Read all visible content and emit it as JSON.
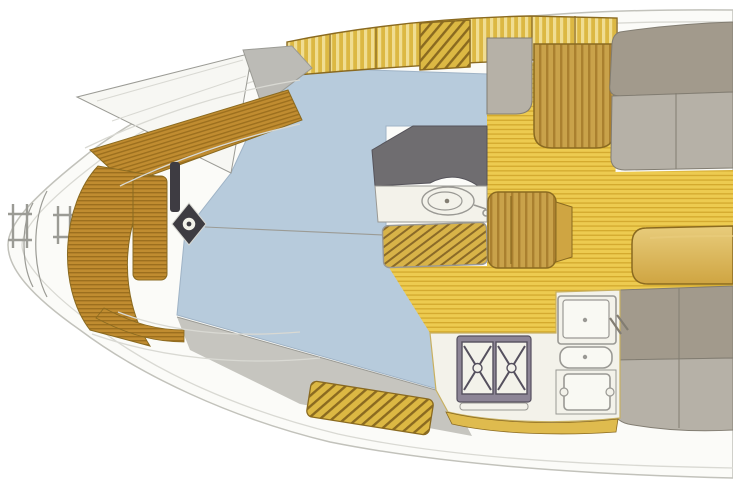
{
  "canvas": {
    "width": 733,
    "height": 488,
    "background": "#ffffff"
  },
  "plan": {
    "type": "sailboat-interior-floor-plan",
    "orientation": "stern-left-bow-right-cropped",
    "regions": [
      "stern-swim-ladder",
      "cockpit",
      "cockpit-teak-benches",
      "helm-pedestal",
      "steering-wheel",
      "sprayhood",
      "companionway-hatch",
      "coachroof",
      "side-deck",
      "deck-lockers",
      "companionway-steps",
      "nav-seat",
      "chart-table",
      "head-compartment",
      "toilet",
      "shower-grate",
      "cabin-sole",
      "wood-seat-locker",
      "port-berth",
      "starboard-settee",
      "saloon-table",
      "galley",
      "stove",
      "double-sink",
      "faucet",
      "icebox"
    ]
  },
  "colors": {
    "hull_fill": "#fbfbf8",
    "hull_line": "#c2c2bb",
    "deck_line": "#d9d9d3",
    "deck_white": "#f7f7f3",
    "blue": "#b7cbdc",
    "blue_line": "#9fb3c6",
    "band_base": "#dcb843",
    "band_light": "#f0dd92",
    "teak_base": "#c08c30",
    "teak_stripe": "#9c6f1e",
    "sole_base": "#edcb50",
    "sole_stripe": "#d3a92e",
    "grate_base": "#d8b348",
    "grate_stripe": "#8a6a28",
    "wood_edge": "#8a6a20",
    "grain_base": "#c9a24a",
    "grain_stripe": "#aa802f",
    "cushion_back": "#a29a8c",
    "cushion_seat": "#b6b1a7",
    "cushion_line": "#827d72",
    "counter_dark": "#6f6d70",
    "counter_edge": "#55535a",
    "white_fixture": "#f3f2ea",
    "fixture_line": "#9a9994",
    "stove_frame": "#8d8596",
    "stove_dark": "#55505e",
    "table_light": "#e8cc7c",
    "table_base": "#cfa542",
    "spray_gray": "#bcbbb6",
    "sidedeck_gray": "#c6c5bf",
    "line_gray": "#9b9b95",
    "pedestal": "#3e3c42",
    "galley_trim": "#c8b060",
    "front_teak": "#dfbb4e"
  }
}
